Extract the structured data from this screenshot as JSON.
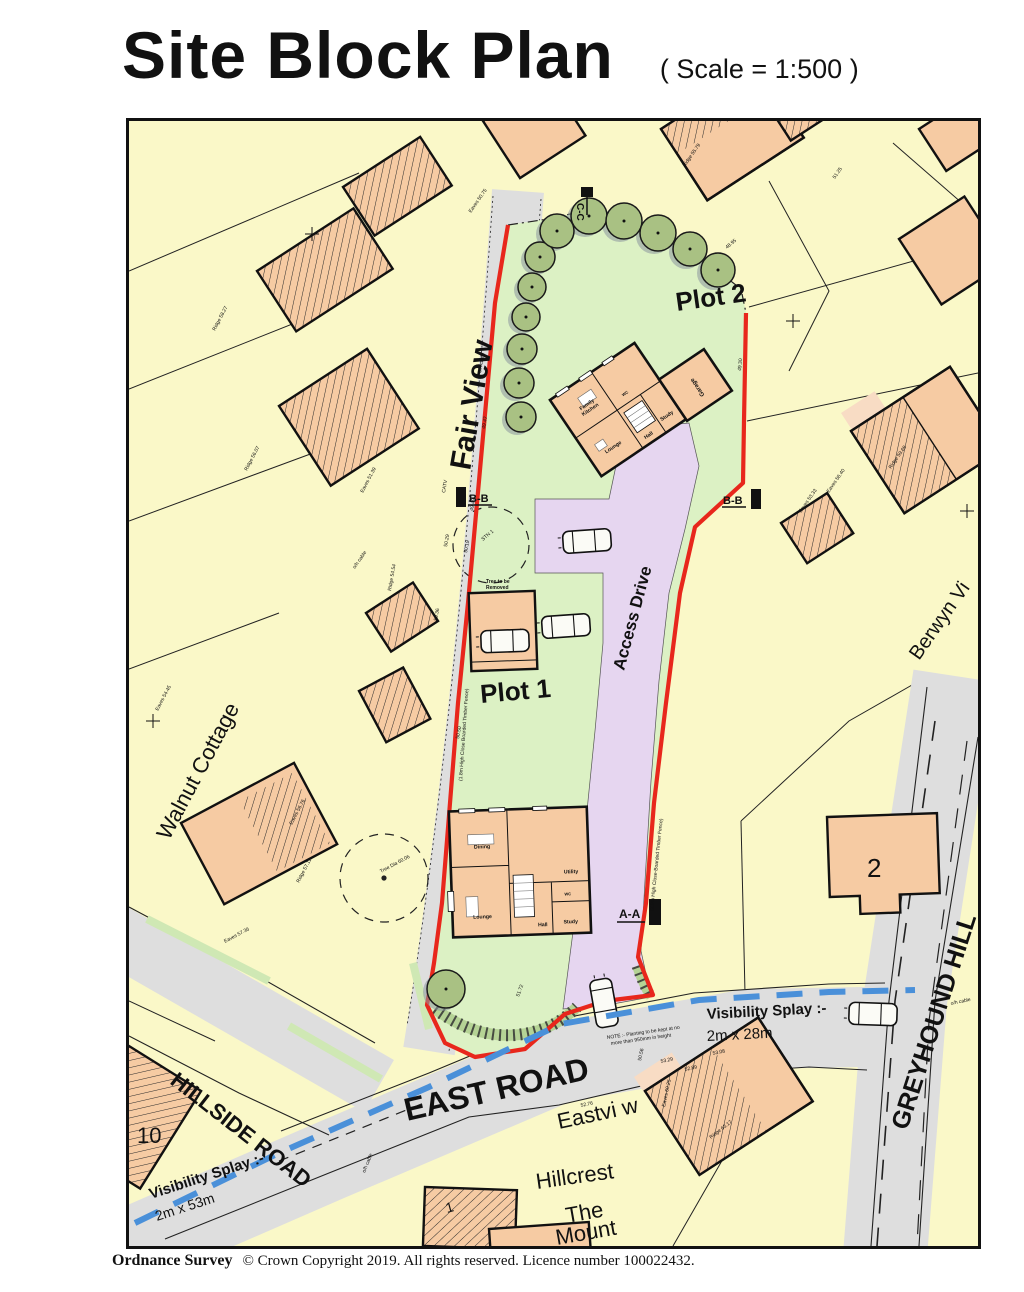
{
  "title": {
    "main": "Site Block Plan",
    "scale": "( Scale = 1:500 )"
  },
  "footer": {
    "brand": "Ordnance Survey",
    "copyright": "© Crown Copyright 2019. All rights reserved.   Licence number 100022432."
  },
  "map": {
    "roads": {
      "fair_view": "Fair View",
      "hillside": "HILLSIDE ROAD",
      "east": "EAST ROAD",
      "greyhound": "GREYHOUND HILL"
    },
    "places": {
      "berwyn": "Berwyn Vi",
      "walnut": "Walnut Cottage",
      "eastview": "Eastvi w",
      "hillcrest": "Hillcrest",
      "mount1": "The",
      "mount2": "Mount",
      "no2": "2",
      "no10": "10",
      "no1": "1"
    },
    "plots": {
      "plot1": "Plot 1",
      "plot2": "Plot 2",
      "access_drive": "Access Drive",
      "garage": "Garage"
    },
    "sections": {
      "aa": "A-A",
      "bb_left": "B-B",
      "bb_right": "B-B",
      "cc": "C-C"
    },
    "splays": {
      "east_title": "Visibility Splay :-",
      "east_dim": "2m x 28m",
      "west_title": "Visibility Splay :-",
      "west_dim": "2m x 53m"
    },
    "notes": {
      "tree1": "Tree to be",
      "tree2": "Removed",
      "plant1": "NOTE :- Planting to be kept at no",
      "plant2": "more than 950mm in height",
      "fence_w": "(1.8m High Close Boarded Timber Fence)",
      "fence_e": "(2.0m High Close-Boarded Timber Fence)"
    },
    "plot2_house": {
      "kitchen1": "Family",
      "kitchen2": "Kitchen",
      "lounge": "Lounge",
      "hall": "Hall",
      "study": "Study",
      "wc": "WC",
      "garage": "Garage"
    },
    "plot1_house": {
      "dining": "Dining",
      "lounge": "Lounge",
      "hall": "Hall",
      "study": "Study",
      "utility": "Utility",
      "wc": "WC"
    },
    "spot_labels": [
      {
        "t": "o/h cable",
        "x": 352,
        "y": 252,
        "r": -80
      },
      {
        "t": "o/h cable",
        "x": 226,
        "y": 448,
        "r": -55
      },
      {
        "t": "o/h cable",
        "x": 236,
        "y": 1052,
        "r": -68
      },
      {
        "t": "o/h cable",
        "x": 822,
        "y": 884,
        "r": -12
      },
      {
        "t": "49.47",
        "x": 356,
        "y": 308,
        "r": -80
      },
      {
        "t": "49.49",
        "x": 344,
        "y": 390,
        "r": -80
      },
      {
        "t": "50.29",
        "x": 318,
        "y": 426,
        "r": -80
      },
      {
        "t": "50.36",
        "x": 308,
        "y": 500,
        "r": -80
      },
      {
        "t": "CATV",
        "x": 316,
        "y": 372,
        "r": -80
      },
      {
        "t": "STN 1",
        "x": 354,
        "y": 420,
        "r": -40
      },
      {
        "t": "50.19",
        "x": 338,
        "y": 432,
        "r": -80
      },
      {
        "t": "Ridge 56.07",
        "x": 118,
        "y": 350,
        "r": -62
      },
      {
        "t": "Eaves 53.33",
        "x": 672,
        "y": 392,
        "r": -55
      },
      {
        "t": "Ridge 59.69",
        "x": 762,
        "y": 348,
        "r": -55
      },
      {
        "t": "Eaves 56.40",
        "x": 700,
        "y": 372,
        "r": -55
      },
      {
        "t": "Ridge 55.79",
        "x": 556,
        "y": 46,
        "r": -55
      },
      {
        "t": "Eaves 60.25",
        "x": 536,
        "y": 986,
        "r": -78
      },
      {
        "t": "Ridge 63.17",
        "x": 582,
        "y": 1018,
        "r": -38
      },
      {
        "t": "Ridge 57.11",
        "x": 170,
        "y": 762,
        "r": -62
      },
      {
        "t": "Eaves 56.76",
        "x": 163,
        "y": 704,
        "r": -62
      },
      {
        "t": "Eaves 54.45",
        "x": 29,
        "y": 590,
        "r": -62
      },
      {
        "t": "Ridge 54.54",
        "x": 262,
        "y": 470,
        "r": -80
      },
      {
        "t": "Eaves 57.36",
        "x": 96,
        "y": 822,
        "r": -28
      },
      {
        "t": "52.76",
        "x": 452,
        "y": 986,
        "r": -12
      },
      {
        "t": "52.84",
        "x": 344,
        "y": 966,
        "r": -12
      },
      {
        "t": "52.89",
        "x": 556,
        "y": 950,
        "r": -12
      },
      {
        "t": "53.08",
        "x": 584,
        "y": 934,
        "r": -12
      },
      {
        "t": "53.29",
        "x": 532,
        "y": 942,
        "r": -12
      },
      {
        "t": "51.72",
        "x": 390,
        "y": 876,
        "r": -70
      },
      {
        "t": "50.50",
        "x": 330,
        "y": 618,
        "r": -80
      },
      {
        "t": "Tree Dia 60.06",
        "x": 252,
        "y": 752,
        "r": -28
      },
      {
        "t": "Eaves 50.75",
        "x": 342,
        "y": 92,
        "r": -55
      },
      {
        "t": "51.25",
        "x": 706,
        "y": 58,
        "r": -55
      },
      {
        "t": "Eaves 51.39",
        "x": 234,
        "y": 372,
        "r": -62
      },
      {
        "t": "Ridge 58.27",
        "x": 86,
        "y": 210,
        "r": -62
      },
      {
        "t": "50.56",
        "x": 512,
        "y": 940,
        "r": -78
      },
      {
        "t": "49.30",
        "x": 612,
        "y": 250,
        "r": -85
      },
      {
        "t": "48.95",
        "x": 598,
        "y": 128,
        "r": -40
      }
    ]
  },
  "colors": {
    "parcel_yellow": "#FAF8C8",
    "building_orange": "#F6CBA3",
    "road_grey": "#DEDEDE",
    "site_green": "#DCF1C4",
    "tree_green": "#A9C183",
    "drive_lavender": "#E6D6F0",
    "boundary_red": "#E8271C",
    "splay_blue": "#4A90D9"
  }
}
